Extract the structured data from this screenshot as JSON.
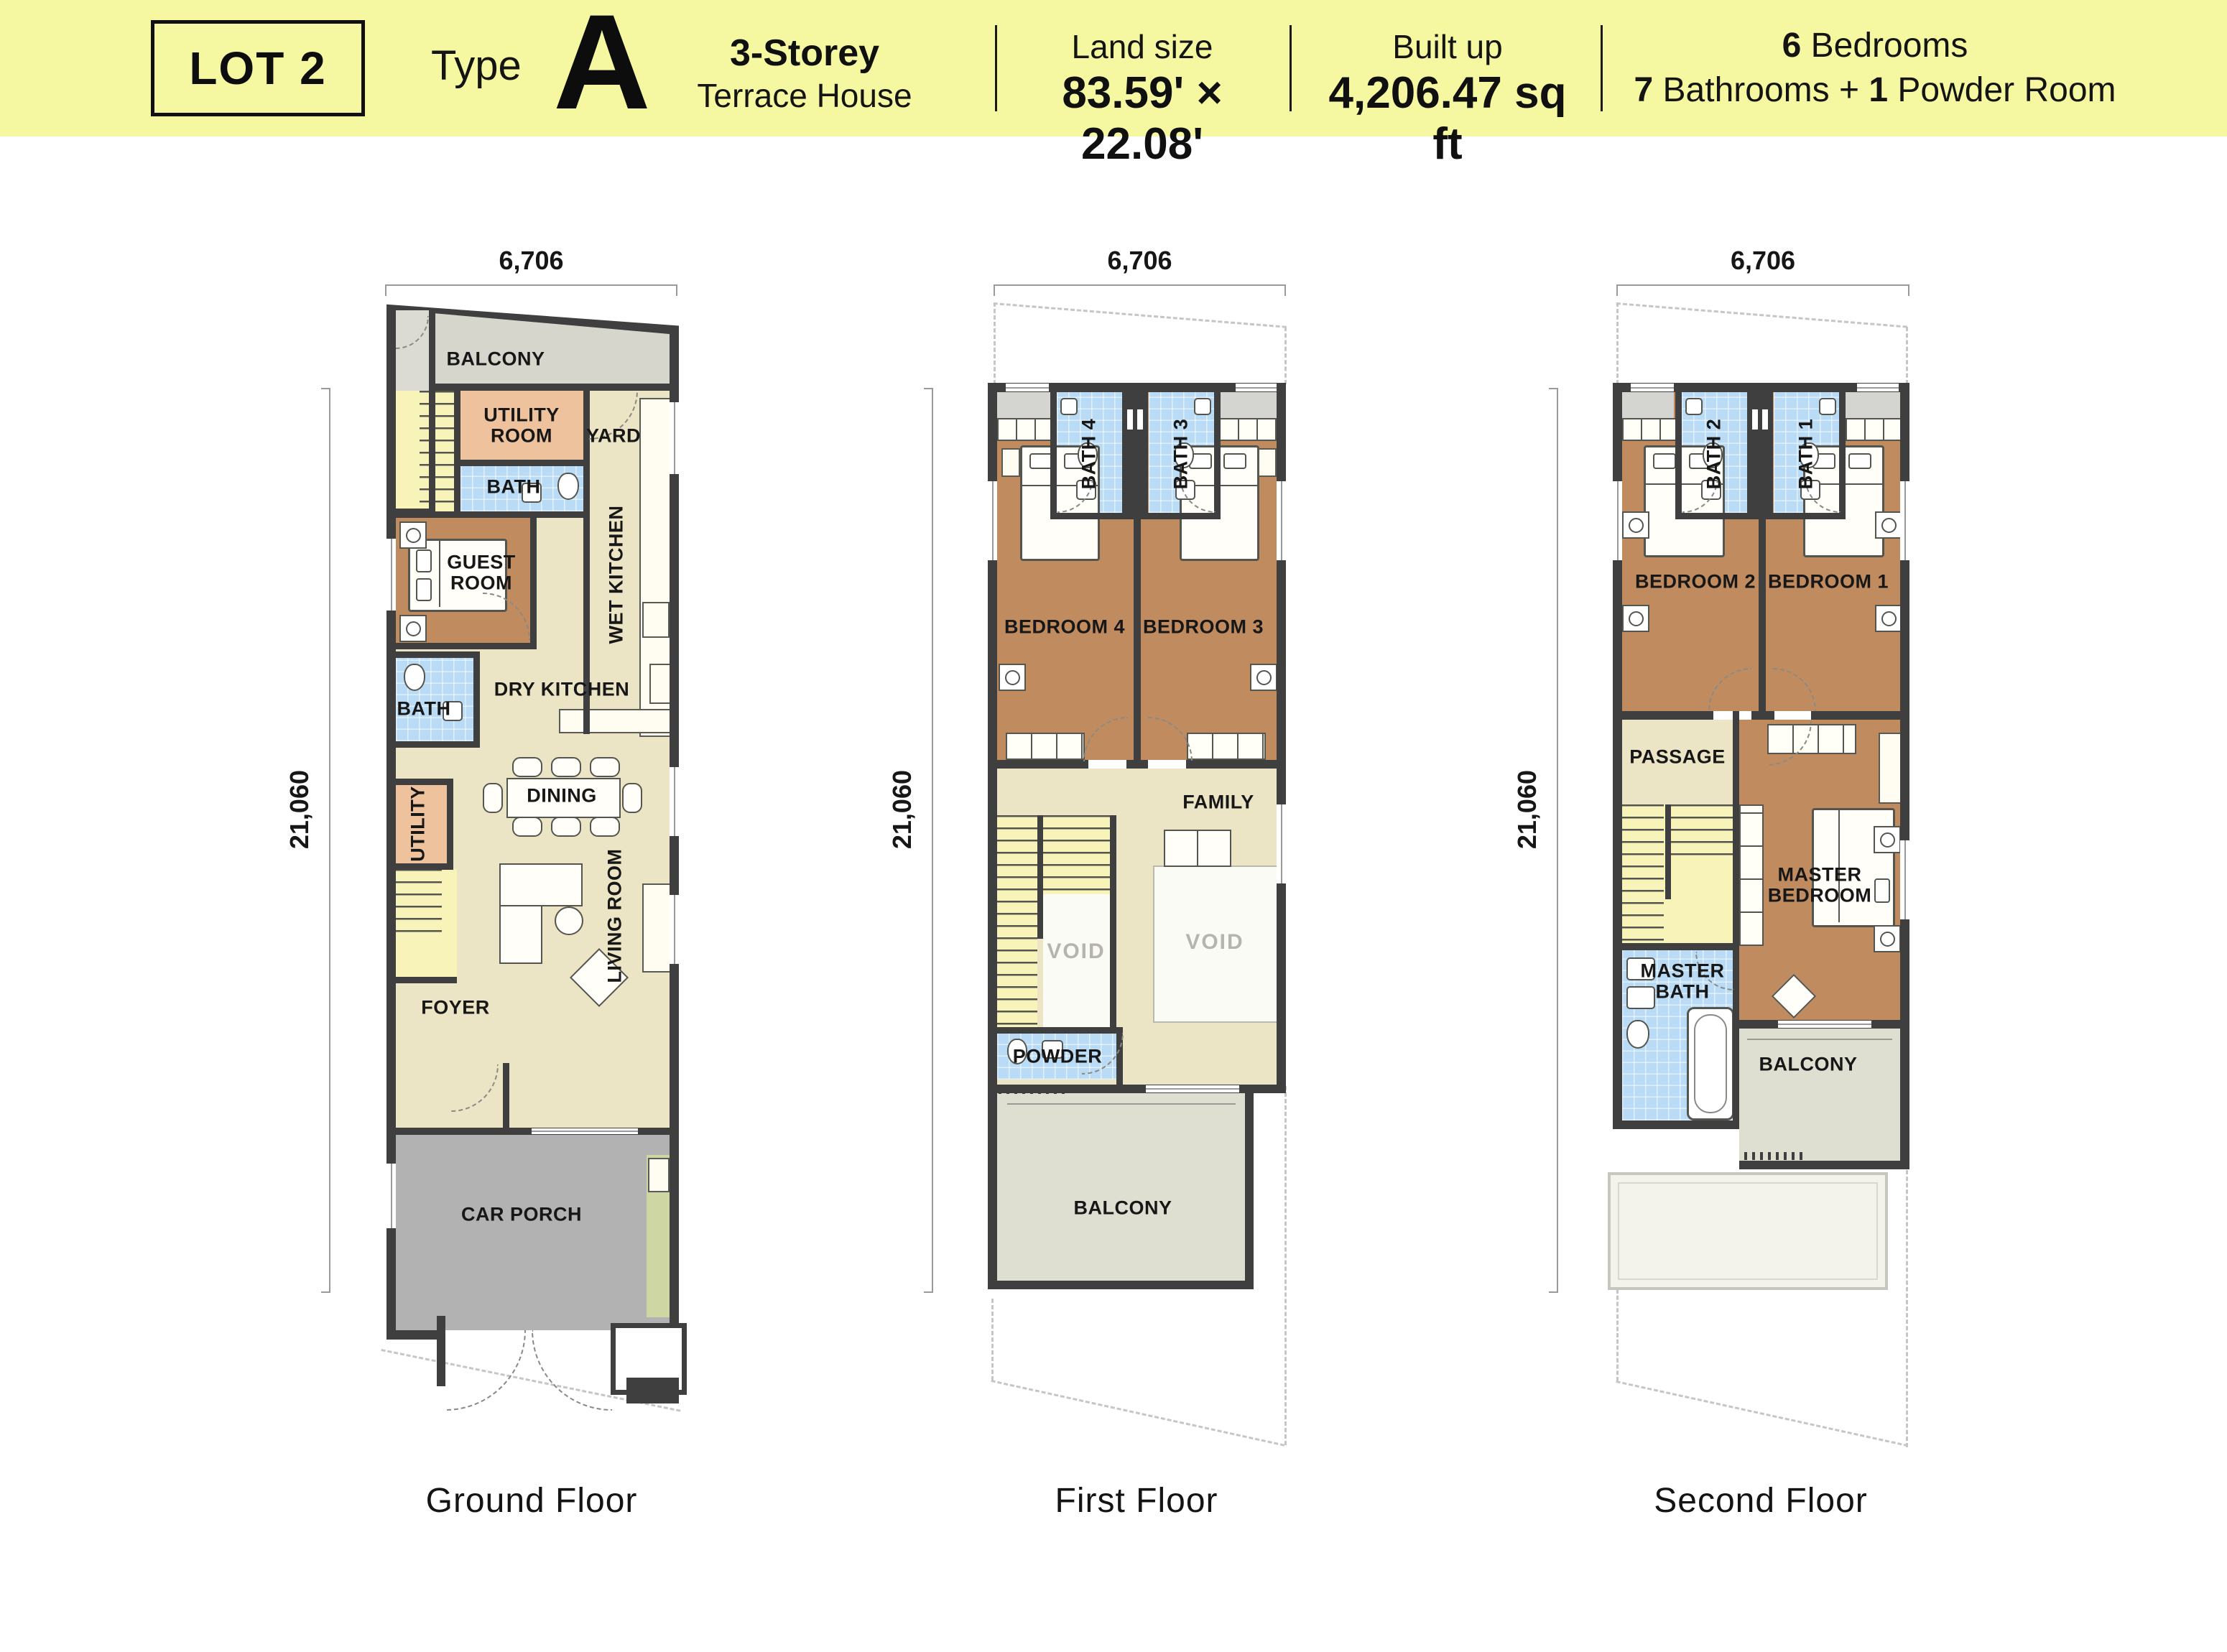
{
  "header": {
    "lot": "LOT 2",
    "type_label": "Type",
    "type_letter": "A",
    "storey": "3-Storey",
    "subtype": "Terrace House",
    "land_size_label": "Land size",
    "land_size_value": "83.59' × 22.08'",
    "built_up_label": "Built up",
    "built_up_value": "4,206.47 sq ft",
    "bedrooms_num": "6",
    "bedrooms_text": "Bedrooms",
    "bathrooms_num": "7",
    "bathrooms_text": "Bathrooms",
    "plus": "+",
    "powder_num": "1",
    "powder_text": "Powder Room"
  },
  "dims": {
    "width": "6,706",
    "depth": "21,060"
  },
  "ground": {
    "label": "Ground Floor",
    "balcony": "BALCONY",
    "utility_room": "UTILITY ROOM",
    "yard": "YARD",
    "bath_upper": "BATH",
    "guest_room": "GUEST ROOM",
    "wet_kitchen": "WET KITCHEN",
    "dry_kitchen": "DRY KITCHEN",
    "bath_lower": "BATH",
    "utility": "UTILITY",
    "dining": "DINING",
    "living_room": "LIVING ROOM",
    "foyer": "FOYER",
    "car_porch": "CAR PORCH"
  },
  "first": {
    "label": "First Floor",
    "bath4": "BATH 4",
    "bath3": "BATH 3",
    "bedroom4": "BEDROOM 4",
    "bedroom3": "BEDROOM 3",
    "family": "FAMILY",
    "void": "VOID",
    "powder": "POWDER",
    "balcony": "BALCONY"
  },
  "second": {
    "label": "Second Floor",
    "bath2": "BATH 2",
    "bath1": "BATH 1",
    "bedroom2": "BEDROOM 2",
    "bedroom1": "BEDROOM 1",
    "passage": "PASSAGE",
    "master_bedroom": "MASTER BEDROOM",
    "master_bath": "MASTER BATH",
    "balcony": "BALCONY"
  },
  "colors": {
    "header_bg": "#f5f8a0",
    "wall": "#3f3f3f",
    "cream": "#ece5c5",
    "bedroom": "#c18b60",
    "peach": "#eec29c",
    "bath": "#badbf5",
    "stairs": "#f8f3b8",
    "balcony_gray": "#d6d6cc",
    "carporch": "#b2b2b2",
    "sage": "#dfdfd1",
    "green": "#ced6a3",
    "roof": "#f3f3ec",
    "dash": "#c6c6c6",
    "dim": "#9a9a9a",
    "void_text": "#b5b5ad",
    "ink": "#171717"
  }
}
